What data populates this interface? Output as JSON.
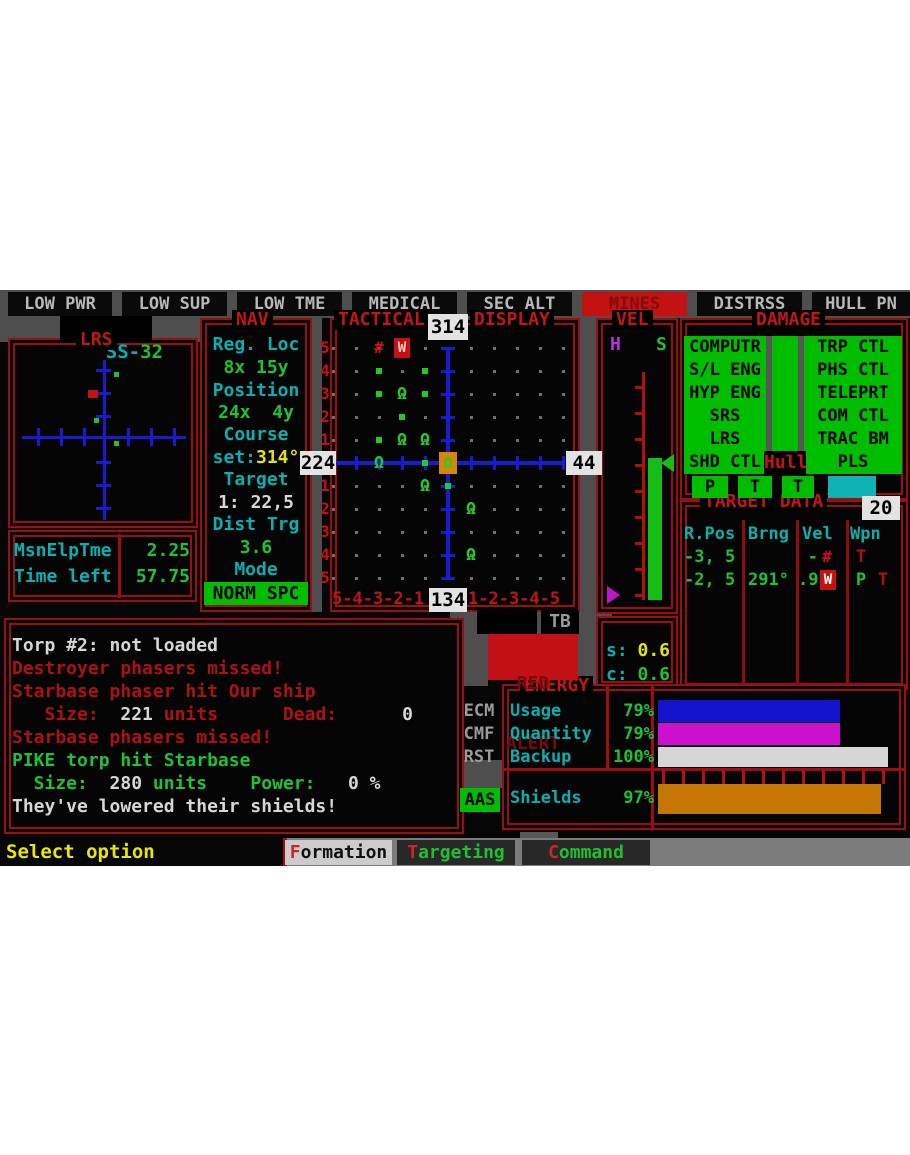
{
  "status_bar": {
    "items": [
      {
        "label": "LOW PWR",
        "alert": false
      },
      {
        "label": "LOW SUP",
        "alert": false
      },
      {
        "label": "LOW TME",
        "alert": false
      },
      {
        "label": "MEDICAL",
        "alert": false
      },
      {
        "label": "SEC ALT",
        "alert": false
      },
      {
        "label": "MINES",
        "alert": true
      },
      {
        "label": "DISTRSS",
        "alert": false
      },
      {
        "label": "HULL PN",
        "alert": false
      }
    ]
  },
  "ship": {
    "prefix": "SS-",
    "number": "32"
  },
  "lrs": {
    "title": "LRS",
    "contacts": [
      {
        "x": 88,
        "y": 100,
        "w": 10,
        "h": 8,
        "color": "#c21414",
        "kind": "hostile"
      },
      {
        "x": 114,
        "y": 82,
        "w": 5,
        "h": 5,
        "color": "#1fc02f",
        "kind": "friendly"
      },
      {
        "x": 94,
        "y": 128,
        "w": 5,
        "h": 5,
        "color": "#1fc02f",
        "kind": "friendly"
      },
      {
        "x": 114,
        "y": 151,
        "w": 5,
        "h": 5,
        "color": "#1fc02f",
        "kind": "friendly"
      }
    ]
  },
  "mission_timer": {
    "rows": [
      {
        "label": "MsnElpTme",
        "value": "2.25"
      },
      {
        "label": "Time left",
        "value": "57.75"
      }
    ]
  },
  "nav": {
    "title": "NAV",
    "items": [
      {
        "segments": [
          {
            "t": "Reg. Loc",
            "c": "cyan"
          }
        ]
      },
      {
        "segments": [
          {
            "t": "8x 15y",
            "c": "green"
          }
        ]
      },
      {
        "segments": [
          {
            "t": "Position",
            "c": "cyan"
          }
        ]
      },
      {
        "segments": [
          {
            "t": "24x  4y",
            "c": "green"
          }
        ]
      },
      {
        "segments": [
          {
            "t": "Course",
            "c": "cyan"
          }
        ]
      },
      {
        "segments": [
          {
            "t": "set:",
            "c": "cyan"
          },
          {
            "t": "314°",
            "c": "yellow"
          }
        ]
      },
      {
        "segments": [
          {
            "t": "Target",
            "c": "cyan"
          }
        ]
      },
      {
        "segments": [
          {
            "t": "1: 22,5",
            "c": "white"
          }
        ]
      },
      {
        "segments": [
          {
            "t": "Dist Trg",
            "c": "cyan"
          }
        ]
      },
      {
        "segments": [
          {
            "t": "3.6",
            "c": "green"
          }
        ]
      },
      {
        "segments": [
          {
            "t": "Mode",
            "c": "cyan"
          }
        ]
      },
      {
        "segments": [
          {
            "t": "NORM SPC",
            "c": "black"
          }
        ],
        "box": true
      }
    ]
  },
  "tactical": {
    "title_left": "TACTICAL",
    "heading": "314",
    "title_right": "DISPLAY",
    "left_value": "224",
    "right_value": "44",
    "bottom_value": "134",
    "row_labels_top": [
      "5",
      "4",
      "3",
      "2",
      "1"
    ],
    "row_labels_bottom": [
      "1",
      "2",
      "3",
      "4",
      "5"
    ],
    "col_labels_left": "5-4-3-2-1",
    "col_labels_right": "1-2-3-4-5",
    "nav_toggle": {
      "left_arrow": "◄",
      "label": "ss",
      "right_arrow": "►"
    },
    "tb_label": "TB",
    "symbols": [
      {
        "col": -3,
        "row": -5,
        "type": "hash"
      },
      {
        "col": -2,
        "row": -5,
        "type": "starbase"
      },
      {
        "col": -3,
        "row": -4,
        "type": "dot"
      },
      {
        "col": -1,
        "row": -4,
        "type": "dot"
      },
      {
        "col": -3,
        "row": -3,
        "type": "dot"
      },
      {
        "col": -2,
        "row": -3,
        "type": "omega"
      },
      {
        "col": -1,
        "row": -3,
        "type": "dot"
      },
      {
        "col": -2,
        "row": -2,
        "type": "dot"
      },
      {
        "col": -3,
        "row": -1,
        "type": "dot"
      },
      {
        "col": -2,
        "row": -1,
        "type": "omega"
      },
      {
        "col": -1,
        "row": -1,
        "type": "omega"
      },
      {
        "col": -3,
        "row": 0,
        "type": "omega"
      },
      {
        "col": -1,
        "row": 0,
        "type": "dot"
      },
      {
        "col": 0,
        "row": 0,
        "type": "player"
      },
      {
        "col": -1,
        "row": 1,
        "type": "omega"
      },
      {
        "col": 0,
        "row": 1,
        "type": "dot"
      },
      {
        "col": 1,
        "row": 2,
        "type": "omega"
      },
      {
        "col": 1,
        "row": 4,
        "type": "omega"
      }
    ]
  },
  "red_alert": {
    "line1": "RED",
    "line2": "ALERT"
  },
  "vel": {
    "title": "VEL",
    "h_label": "H",
    "s_label": "S",
    "s_row": {
      "label": "s:",
      "value": "0.6"
    },
    "c_row": {
      "label": "c:",
      "value": "0.6"
    }
  },
  "damage": {
    "title": "DAMAGE",
    "left_systems": [
      "COMPUTR",
      "S/L ENG",
      "HYP ENG",
      "SRS",
      "LRS",
      "SHD CTL"
    ],
    "right_systems": [
      "TRP CTL",
      "PHS CTL",
      "TELEPRT",
      "COM CTL",
      "TRAC BM",
      "PLS"
    ],
    "hull_label": "Hull",
    "status_boxes": [
      "P",
      "T",
      "T"
    ]
  },
  "target_data": {
    "title": "TARGET DATA",
    "count": "20",
    "headers": [
      "R.Pos",
      "Brng",
      "Vel",
      "Wpn"
    ],
    "rows": [
      {
        "rpos": "-3, 5",
        "brng": "",
        "vel_text": "-",
        "vel_icon": "hash",
        "wpn": [
          {
            "t": "T",
            "c": "red"
          }
        ]
      },
      {
        "rpos": "-2, 5",
        "brng": "291°",
        "vel_text": ".9",
        "vel_icon": "starbase",
        "wpn": [
          {
            "t": "P",
            "c": "green"
          },
          {
            "t": "T",
            "c": "red"
          }
        ]
      }
    ]
  },
  "messages": [
    {
      "segments": [
        {
          "t": "Torp #2: not loaded",
          "c": "white"
        }
      ]
    },
    {
      "segments": [
        {
          "t": "Destroyer phasers missed!",
          "c": "red"
        }
      ]
    },
    {
      "segments": [
        {
          "t": "Starbase phaser hit Our ship",
          "c": "red"
        }
      ]
    },
    {
      "segments": [
        {
          "t": "   Size:  ",
          "c": "red"
        },
        {
          "t": "221",
          "c": "white"
        },
        {
          "t": " units      Dead:",
          "c": "red"
        },
        {
          "t": "      0",
          "c": "white"
        }
      ]
    },
    {
      "segments": [
        {
          "t": "Starbase phasers missed!",
          "c": "red"
        }
      ]
    },
    {
      "segments": [
        {
          "t": "PIKE torp hit Starbase",
          "c": "green"
        }
      ]
    },
    {
      "segments": [
        {
          "t": "  Size:  ",
          "c": "green"
        },
        {
          "t": "280",
          "c": "white"
        },
        {
          "t": " units    Power:",
          "c": "green"
        },
        {
          "t": "   0 %",
          "c": "white"
        }
      ]
    },
    {
      "segments": [
        {
          "t": "They've lowered their shields!",
          "c": "white"
        }
      ]
    }
  ],
  "energy": {
    "title": "ENERGY",
    "side_labels": [
      "ECM",
      "CMF",
      "RST"
    ],
    "aas_label": "AAS",
    "rows": [
      {
        "label": "Usage",
        "value": "79%",
        "pct": 79,
        "color": "#1414cc"
      },
      {
        "label": "Quantity",
        "value": "79%",
        "pct": 79,
        "color": "#cc10cc"
      },
      {
        "label": "Backup",
        "value": "100%",
        "pct": 100,
        "color": "#d6d6d6"
      },
      {
        "label": "Shields",
        "value": "97%",
        "pct": 97,
        "color": "#c67605"
      }
    ]
  },
  "footer": {
    "prompt": "Select option",
    "menu": [
      {
        "hotkey": "F",
        "rest": "ormation",
        "selected": true
      },
      {
        "hotkey": "T",
        "rest": "argeting",
        "selected": false
      },
      {
        "hotkey": "C",
        "rest": "ommand",
        "selected": false
      }
    ]
  }
}
